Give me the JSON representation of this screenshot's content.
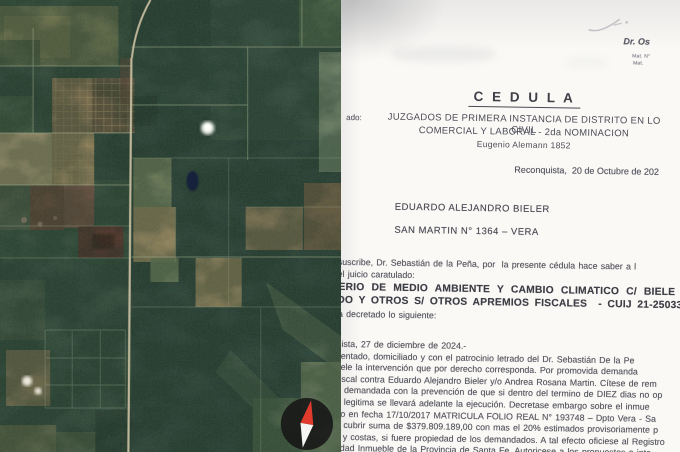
{
  "left_panel": {
    "type": "satellite-imagery",
    "icons": {
      "compass": "compass-icon"
    }
  },
  "doc": {
    "letterhead": {
      "name": "Dr. Os",
      "mat1": "Mat. N°",
      "mat2": "Mat."
    },
    "title": "C E D U L A",
    "addressed_label": "ado:",
    "court": [
      "JUZGADOS DE PRIMERA INSTANCIA DE DISTRITO EN LO CIVIL",
      "COMERCIAL Y LABORAL -  2da NOMINACION",
      "Eugenio Alemann 1852"
    ],
    "dateline": "Reconquista,  20 de Octubre de 202",
    "addressee": {
      "name": "EDUARDO ALEJANDRO BIELER",
      "address": "SAN MARTIN N° 1364 – VERA"
    },
    "intro": [
      "suscribe, Dr. Sebastián de la Peña, por  la presente cédula hace saber a l",
      "el juicio caratulado:"
    ],
    "case": [
      "ERIO DE MEDIO AMBIENTE Y CAMBIO CLIMATICO C/ BIELE",
      "DO Y OTROS S/ OTROS APREMIOS FISCALES  - CUIJ 21-250331"
    ],
    "decree_intro": "a decretado lo siguiente:",
    "body": [
      "uista, 27 de diciembre de 2024.-",
      "sentado, domiciliado y con el patrocinio letrado del Dr. Sebastián De la Pe",
      "sele la intervención que por derecho corresponda. Por promovida demanda",
      "fiscal contra Eduardo Alejandro Bieler y/o Andrea Rosana Martin. Cítese de rem",
      "e demandada con la prevención de que si dentro del termino de DIEZ dias no op",
      "n legitima se llevará adelante la ejecución. Decretase embargo sobre el inmue",
      "do en fecha 17/10/2017 MATRICULA FOLIO REAL N° 193748 – Dpto Vera - Sa",
      "a cubrir suma de $379.809.189,00 con mas el 20% estimados provisoriamente p",
      "s y costas, si fuere propiedad de los demandados. A tal efecto oficiese al Registro",
      "edad Inmueble de la Provincia de Santa Fe. Autoricese a los propuestos e inte"
    ]
  },
  "theme": {
    "paper": "#faf9f6",
    "ink": "#55555e",
    "ink_bold": "#3d3d45",
    "map_base": "#2b433a",
    "map_sage": "#7c8a64",
    "map_tan": "#a79267",
    "road": "#c6bd9f",
    "gridline": "#a2b08f",
    "compass_bg": "#161616",
    "compass_red": "#e03b2c",
    "compass_white": "#f5f5f3",
    "pond_dark": "#15243a"
  }
}
